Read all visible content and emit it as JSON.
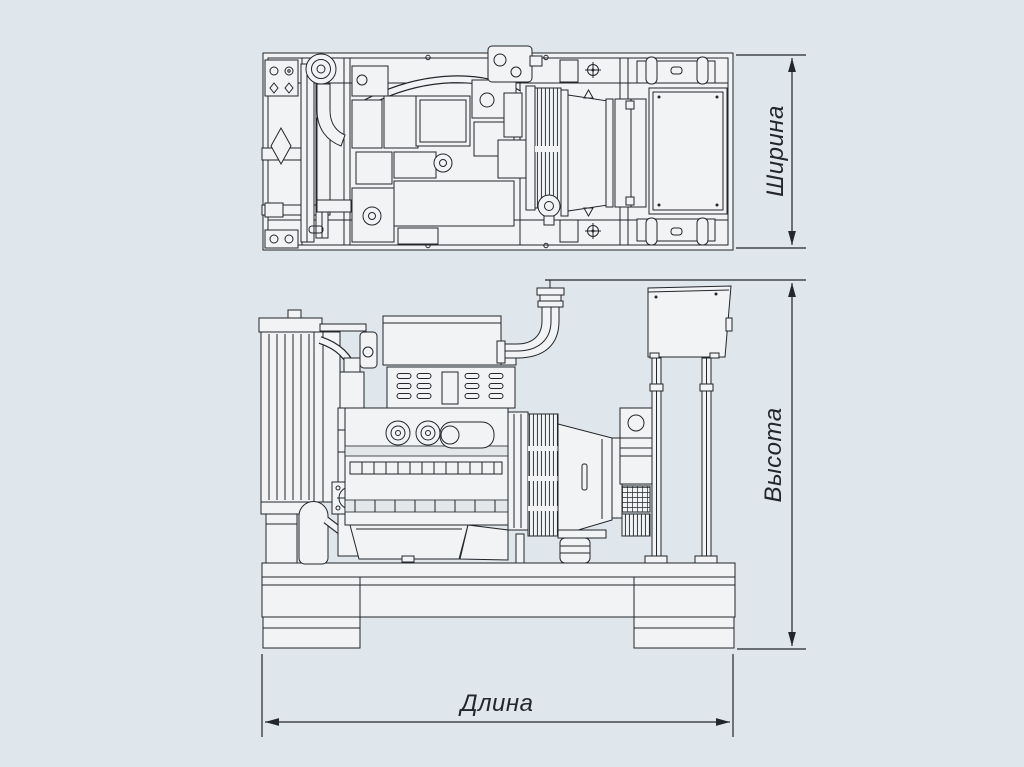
{
  "figure": {
    "kind": "technical-dimension-drawing",
    "views": [
      "top-view",
      "side-view"
    ]
  },
  "dimension_labels": {
    "width": "Ширина",
    "height": "Высота",
    "length": "Длина"
  },
  "colors": {
    "background": "#dfe6ec",
    "line": "#23262a",
    "part_fill": "#f1f3f5",
    "part_shade": "#e3e7ea"
  }
}
